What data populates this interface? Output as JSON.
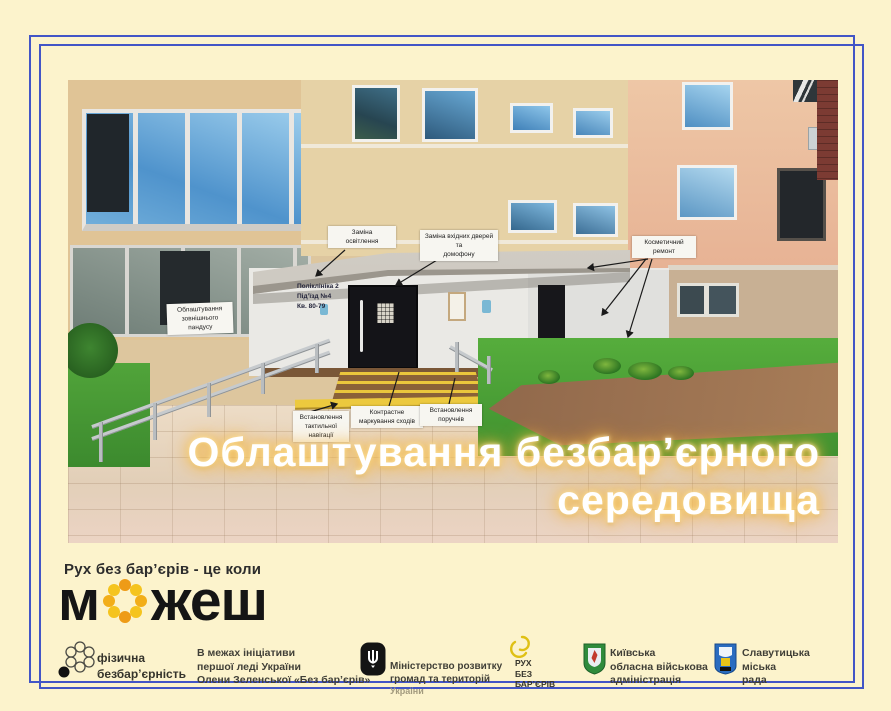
{
  "title": {
    "line1": "Облаштування безбар’єрного",
    "line2": "середовища"
  },
  "tagline": "Рух без бар’єрів - це коли",
  "brand": {
    "left": "м",
    "right": "жеш"
  },
  "photo_labels": {
    "ramp": "Облаштування\nзовнішнього\nпандусу",
    "lighting": "Заміна\nосвітлення",
    "doors": "Заміна вхідних дверей та\nдомофону",
    "cosmetic": "Косметичний\nремонт",
    "tactile": "Встановлення\nтактильної\nнавігації",
    "stairs_marking": "Контрастне\nмаркування сходів",
    "handrails": "Встановлення\nпоручнів",
    "wall_sign": "Поліклініка 2\nПід’їзд №4\nКв. 80-79"
  },
  "footer": {
    "physical": "фізична\nбезбар’єрність",
    "initiative": "В межах ініціативи\nпершої леді України\nОлени Зеленської «Без бар’єрів»",
    "ministry_name": "Міністерство розвитку\nгромад та територій",
    "ministry_country": "України",
    "rukh": "РУХ\nБЕЗ\nБАР’ЄРІВ",
    "kyiv": "Київська\nобласна військова\nадміністрація",
    "slavutych": "Славутицька\nміська\nрада"
  },
  "colors": {
    "background": "#fcf3cc",
    "frame_blue": "#4255c6",
    "title_glow": "#f2a93b",
    "dot_orange": "#ee9b17",
    "dot_yellow": "#f5c41e"
  }
}
